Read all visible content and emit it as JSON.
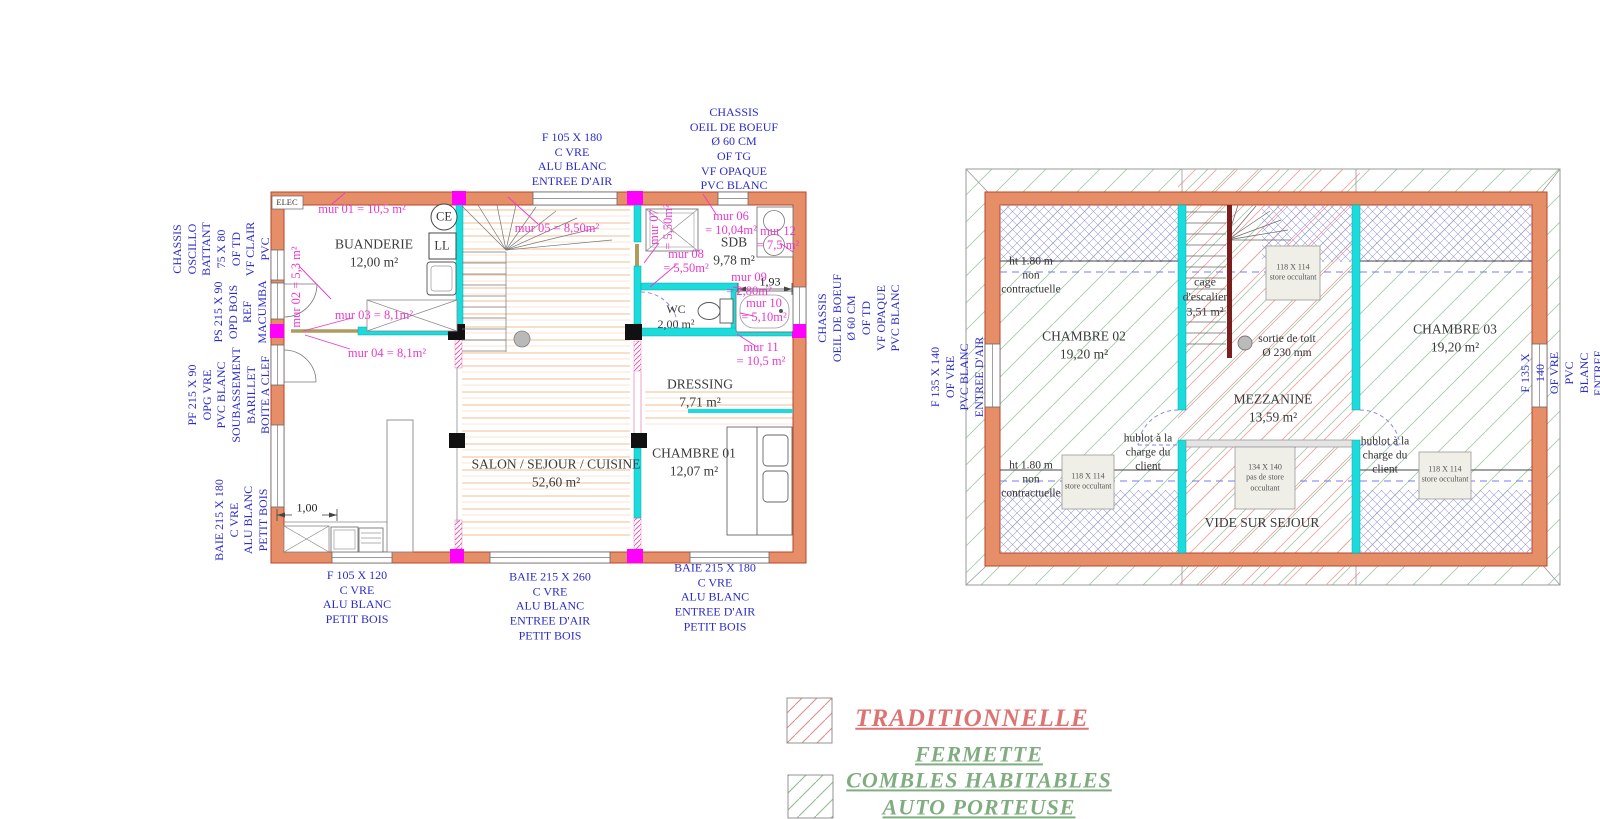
{
  "ground_floor": {
    "elec_label": "ELEC",
    "rooms": {
      "buanderie": "BUANDERIE\n12,00 m²",
      "salon": "SALON / SEJOUR / CUISINE\n52,60 m²",
      "chambre01": "CHAMBRE 01\n12,07 m²",
      "dressing": "DRESSING\n7,71 m²",
      "wc": "WC\n2,00 m²",
      "sdb": "SDB\n9,78 m²"
    },
    "appliances": {
      "water_heater": "CE",
      "washing_machine": "LL"
    },
    "wall_areas": {
      "mur01": "mur 01 = 10,5 m²",
      "mur02": "mur 02 = 5,3 m²",
      "mur03": "mur 03 = 8,1m²",
      "mur04": "mur 04 = 8,1m²",
      "mur05": "mur 05 = 8,50m²",
      "mur06": "mur 06\n= 10,04m²",
      "mur07": "mur 07\n= 5,50m²",
      "mur08": "mur 08\n= 5,50m²",
      "mur09": "mur 09\n= 2,80m²",
      "mur10": "mur 10\n= 5,10m²",
      "mur11": "mur 11\n= 10,5 m²",
      "mur12": "mur 12\n= 7,5 m²"
    },
    "dimensions": {
      "kitchen_width": "1,00",
      "sdb_width": "1,93"
    },
    "openings": {
      "top_window": "F 105 X 180\nC VRE\nALU BLANC\nENTREE D'AIR",
      "top_bullseye": "CHASSIS\nOEIL DE BOEUF\nØ 60 CM\nOF TG\nVF OPAQUE\nPVC BLANC",
      "left_chassis": "CHASSIS\nOSCILLO\nBATTANT\n75 X 80\nOF TD\nVF CLAIR\nPVC",
      "left_door": "PS 215 X 90\nOPD BOIS\nREF\nMACUMBA",
      "left_pf": "PF 215 X 90\nOPG VRE\nPVC BLANC\nSOUBASSEMENT\nBARILLET\nBOITE A CLEF",
      "left_baie": "BAIE 215 X 180\nC VRE\nALU BLANC\nPETIT BOIS",
      "right_bullseye": "CHASSIS\nOEIL DE BOEUF\nØ 60 CM\nOF TD\nVF OPAQUE\nPVC BLANC",
      "bottom_f105": "F 105 X 120\nC VRE\nALU BLANC\nPETIT BOIS",
      "bottom_baie260": "BAIE 215 X 260\nC VRE\nALU BLANC\nENTREE D'AIR\nPETIT BOIS",
      "bottom_baie180": "BAIE 215 X 180\nC VRE\nALU BLANC\nENTREE D'AIR\nPETIT BOIS"
    }
  },
  "first_floor": {
    "rooms": {
      "chambre02": "CHAMBRE 02\n19,20 m²",
      "chambre03": "CHAMBRE 03\n19,20 m²",
      "mezzanine": "MEZZANINE\n13,59 m²",
      "stairwell": "cage\nd'escalier\n3,51 m²",
      "void": "VIDE SUR SEJOUR"
    },
    "annotations": {
      "roof_outlet": "sortie de toit\nØ 230 mm",
      "hublot_left": "hublot à la\ncharge du\nclient",
      "hublot_right": "hublot à la\ncharge du\nclient",
      "height_top": "ht 1.80 m\nnon\ncontractuelle",
      "height_bottom": "ht 1.80 m\nnon\ncontractuelle"
    },
    "roof_windows": {
      "top": "118 X 114\nstore occultant",
      "bottom_left": "118 X 114\nstore occultant",
      "bottom_middle": "134 X 140\npas de store\noccultant",
      "bottom_right": "118 X 114\nstore occultant"
    },
    "openings": {
      "left_window": "F 135 X 140\nOF VRE\nPVC BLANC\nENTREE D'AIR",
      "right_window": "F 135 X 140\nOF VRE\nPVC BLANC\nENTREE D'AIR"
    }
  },
  "legend": {
    "traditionnelle": "TRADITIONNELLE",
    "fermette": "FERMETTE\nCOMBLES HABITABLES\nAUTO PORTEUSE"
  },
  "colors": {
    "wall_fill": "#E68E67",
    "wall_stroke": "#B5472E",
    "partition_cyan": "#1ADCDC",
    "post_black": "#111111",
    "cap_magenta": "#FF00FF",
    "stair_stringer": "#7A1E1E",
    "annotation_blue": "#2B2BCB",
    "annotation_magenta": "#E93ACB",
    "hatch_green": "#A9C9A9",
    "hatch_red": "#EFA3A3",
    "hatch_blue": "#9B9BD8",
    "legend_red": "#DD7373",
    "legend_green": "#7FAD7F"
  }
}
